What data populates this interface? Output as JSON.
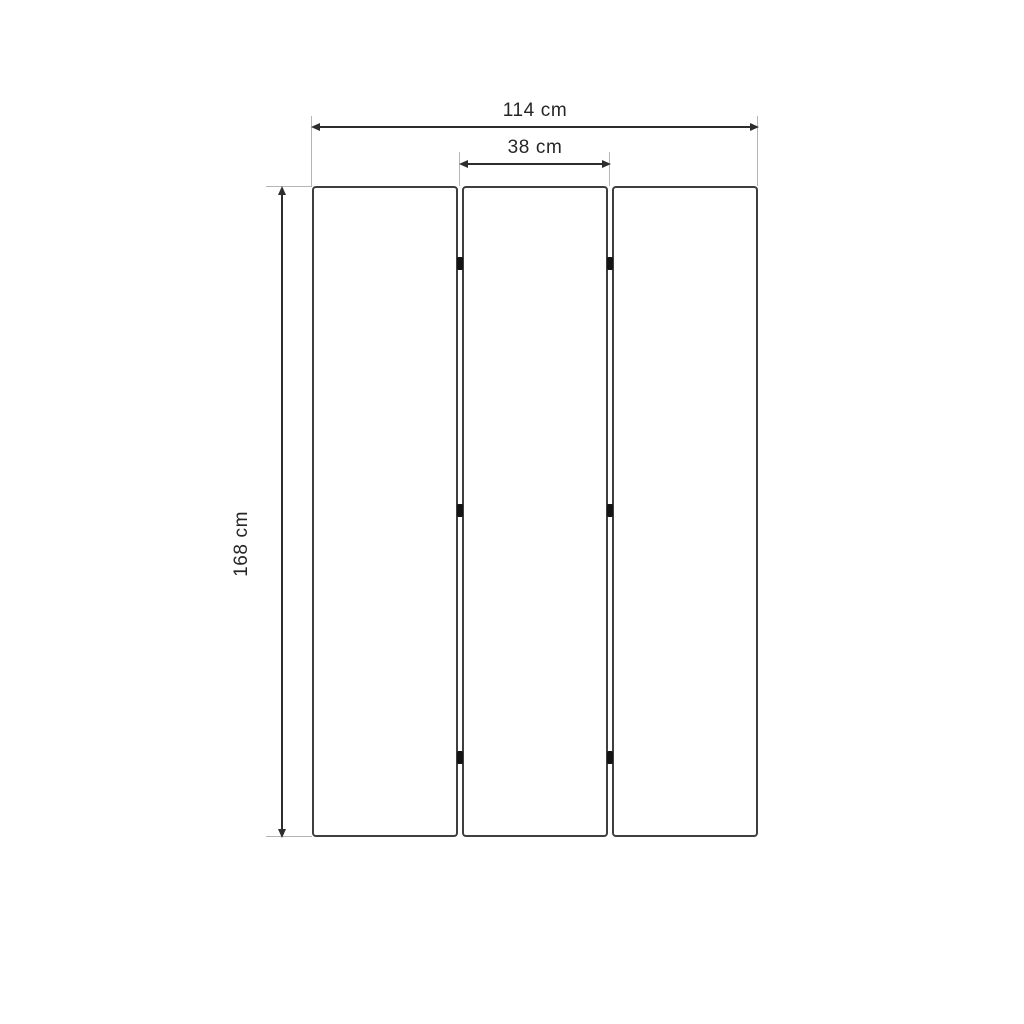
{
  "diagram": {
    "kind": "furniture-dimension-drawing",
    "panel_count": 3,
    "hinge_joints": 2,
    "hinges_per_joint": 3,
    "dimensions": {
      "total_width": "114 cm",
      "panel_width": "38 cm",
      "height": "168 cm"
    },
    "colors": {
      "background": "#ffffff",
      "panel_outline": "#3e3e3e",
      "dimension_line": "#2d2d2d",
      "extension_line": "#b5b5b5",
      "hinge": "#141414",
      "label_text": "#262626"
    }
  }
}
